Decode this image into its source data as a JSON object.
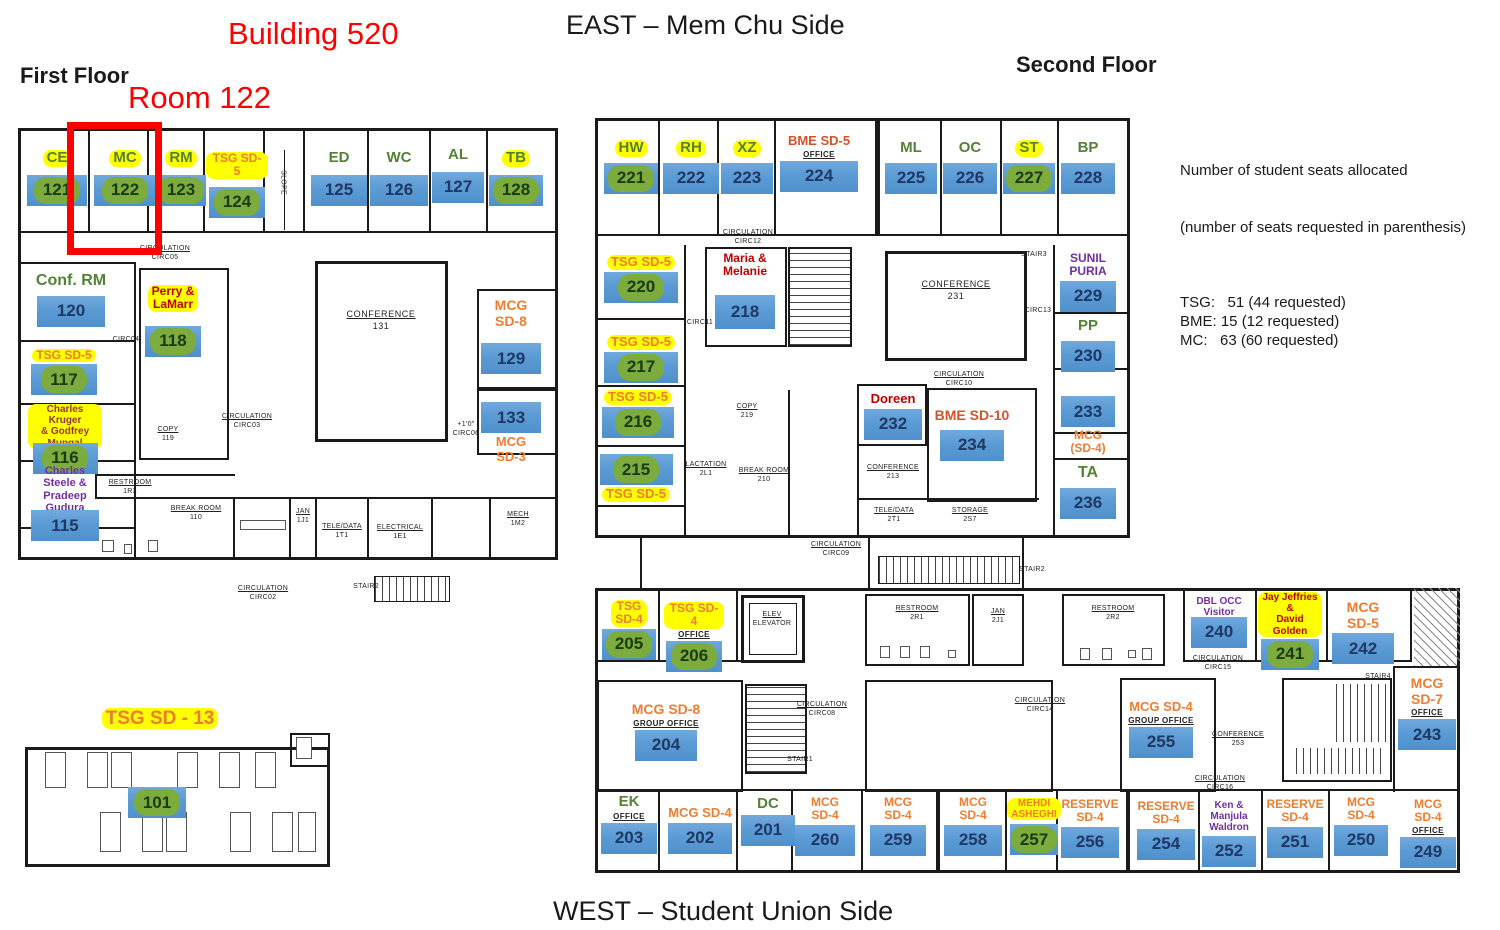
{
  "titles": {
    "building": "Building 520",
    "room_callout": "Room 122",
    "east_side": "EAST – Mem Chu Side",
    "west_side": "WEST – Student Union Side",
    "first_floor": "First Floor",
    "second_floor": "Second Floor"
  },
  "legend": {
    "heading1": "Number of student seats allocated",
    "heading2": "(number of seats requested in parenthesis)",
    "entries": [
      "TSG:   51 (44 requested)",
      "BME: 15 (12 requested)",
      "MC:   63 (60 requested)"
    ]
  },
  "colors": {
    "bar_blue": "#5b9bd5",
    "bar_text": "#1f3864",
    "pill_green": "#7cab3e",
    "pill_text": "#1c3a11",
    "highlight_yellow": "#ffff00",
    "label_green": "#538135",
    "label_orange": "#ed7d31",
    "label_red": "#c00000",
    "label_red_orange": "#d9512c",
    "label_purple": "#7030a0",
    "label_dark_red": "#943634",
    "title_red": "#ff0000",
    "plan_line": "#1a1a1a"
  },
  "floors": [
    {
      "name": "First Floor",
      "rooms": [
        {
          "l": "CE",
          "ls": "gy",
          "n": "121",
          "ns": "pill",
          "x": 26,
          "y": 150,
          "w": 62,
          "bw": 60,
          "fs": 15,
          "mt": 8
        },
        {
          "l": "MC",
          "ls": "gy",
          "n": "122",
          "ns": "pill",
          "x": 93,
          "y": 150,
          "w": 64,
          "bw": 62,
          "fs": 15,
          "mt": 8
        },
        {
          "l": "RM",
          "ls": "gy",
          "n": "123",
          "ns": "pill",
          "x": 156,
          "y": 150,
          "w": 50,
          "bw": 50,
          "fs": 15,
          "mt": 8
        },
        {
          "l": "TSG SD-5",
          "ls": "oy",
          "n": "124",
          "ns": "pill",
          "x": 206,
          "y": 152,
          "w": 62,
          "bw": 56,
          "fs": 12,
          "mt": 8
        },
        {
          "l": "ED",
          "ls": "g",
          "n": "125",
          "ns": "bar",
          "x": 310,
          "y": 150,
          "w": 58,
          "bw": 56,
          "fs": 15,
          "mt": 8
        },
        {
          "l": "WC",
          "ls": "g",
          "n": "126",
          "ns": "bar",
          "x": 370,
          "y": 150,
          "w": 58,
          "bw": 58,
          "fs": 15,
          "mt": 8
        },
        {
          "l": "AL",
          "ls": "g",
          "n": "127",
          "ns": "bar",
          "x": 430,
          "y": 147,
          "w": 56,
          "bw": 52,
          "fs": 15,
          "mt": 8
        },
        {
          "l": "TB",
          "ls": "gy",
          "n": "128",
          "ns": "pill",
          "x": 488,
          "y": 150,
          "w": 56,
          "bw": 54,
          "fs": 15,
          "mt": 8
        },
        {
          "l": "Conf. RM",
          "ls": "g",
          "n": "120",
          "ns": "bar",
          "x": 28,
          "y": 272,
          "w": 86,
          "bw": 68,
          "fs": 16,
          "mt": 6
        },
        {
          "l": "TSG SD-5",
          "ls": "oy",
          "n": "117",
          "ns": "pill",
          "x": 28,
          "y": 349,
          "w": 72,
          "bw": 66,
          "fs": 12
        },
        {
          "l": "Charles Kruger\n& Godfrey\nMungal",
          "ls": "dy",
          "n": "116",
          "ns": "pill",
          "x": 28,
          "y": 404,
          "w": 74,
          "bw": 65,
          "fs": 10,
          "mt": -6
        },
        {
          "l": "Charles Steele &\nPradeep Gudura",
          "ls": "p",
          "n": "115",
          "ns": "bar",
          "x": 26,
          "y": 465,
          "w": 78,
          "bw": 68,
          "fs": 11,
          "mt": -4
        },
        {
          "l": "Perry &\nLaMarr",
          "ls": "ry",
          "n": "118",
          "ns": "pill",
          "x": 142,
          "y": 285,
          "w": 62,
          "bw": 56,
          "fs": 12,
          "mt": 14
        },
        {
          "l": "MCG\nSD-8",
          "ls": "o",
          "n": "129",
          "ns": "bar",
          "x": 480,
          "y": 298,
          "w": 62,
          "bw": 60,
          "fs": 14,
          "mt": 14
        },
        {
          "n": "133",
          "ns": "bar",
          "x": 480,
          "y": 400,
          "w": 62,
          "bw": 60,
          "lb": "MCG SD-3",
          "lbs": "o",
          "lbfs": 13
        },
        {
          "l": "TSG SD - 13",
          "ls": "oy",
          "x": 92,
          "y": 708,
          "w": 136,
          "fs": 19
        },
        {
          "n": "101",
          "ns": "pill",
          "x": 126,
          "y": 785,
          "w": 62,
          "bw": 58
        }
      ],
      "plan_labels": [
        {
          "t": "CIRCULATION",
          "s": "CIRC05",
          "x": 165,
          "y": 244
        },
        {
          "t": "CIRC04",
          "x": 126,
          "y": 335,
          "plain": 1
        },
        {
          "t": "CONFERENCE",
          "s": "131",
          "x": 381,
          "y": 309,
          "big": 1
        },
        {
          "t": "CIRCULATION",
          "s": "CIRC03",
          "x": 247,
          "y": 412
        },
        {
          "t": "COPY",
          "s": "119",
          "x": 168,
          "y": 425
        },
        {
          "t": "+1'0\"",
          "s": "CIRC06",
          "x": 466,
          "y": 420,
          "plain": 1
        },
        {
          "t": "RESTROOM",
          "s": "1R3",
          "x": 130,
          "y": 478
        },
        {
          "t": "BREAK ROOM",
          "s": "110",
          "x": 196,
          "y": 504
        },
        {
          "t": "JAN",
          "s": "1J1",
          "x": 303,
          "y": 507
        },
        {
          "t": "TELE/DATA",
          "s": "1T1",
          "x": 342,
          "y": 522
        },
        {
          "t": "ELECTRICAL",
          "s": "1E1",
          "x": 400,
          "y": 523
        },
        {
          "t": "MECH",
          "s": "1M2",
          "x": 518,
          "y": 510
        },
        {
          "t": "CIRCULATION",
          "s": "CIRC02",
          "x": 263,
          "y": 584
        },
        {
          "t": "STAIR2",
          "x": 366,
          "y": 582,
          "plain": 1
        },
        {
          "t": "SLOPE",
          "x": 283,
          "y": 178,
          "rot": 1,
          "plain": 1
        }
      ]
    },
    {
      "name": "Second Floor",
      "rooms": [
        {
          "l": "HW",
          "ls": "gy",
          "n": "221",
          "ns": "pill",
          "x": 602,
          "y": 140,
          "w": 58,
          "bw": 54,
          "fs": 15,
          "mt": 6
        },
        {
          "l": "RH",
          "ls": "gy",
          "n": "222",
          "ns": "bar",
          "x": 662,
          "y": 140,
          "w": 58,
          "bw": 56,
          "fs": 15,
          "mt": 6
        },
        {
          "l": "XZ",
          "ls": "gy",
          "n": "223",
          "ns": "bar",
          "x": 720,
          "y": 140,
          "w": 54,
          "bw": 52,
          "fs": 15,
          "mt": 6
        },
        {
          "l": "BME SD-5",
          "ls": "ro",
          "n": "224",
          "ns": "bar",
          "x": 776,
          "y": 134,
          "w": 86,
          "bw": 78,
          "fs": 13,
          "sub": "OFFICE"
        },
        {
          "l": "ML",
          "ls": "g",
          "n": "225",
          "ns": "bar",
          "x": 884,
          "y": 140,
          "w": 54,
          "bw": 52,
          "fs": 15,
          "mt": 6
        },
        {
          "l": "OC",
          "ls": "g",
          "n": "226",
          "ns": "bar",
          "x": 942,
          "y": 140,
          "w": 56,
          "bw": 54,
          "fs": 15,
          "mt": 6
        },
        {
          "l": "ST",
          "ls": "gy",
          "n": "227",
          "ns": "pill",
          "x": 1002,
          "y": 140,
          "w": 54,
          "bw": 52,
          "fs": 15,
          "mt": 6
        },
        {
          "l": "BP",
          "ls": "g",
          "n": "228",
          "ns": "bar",
          "x": 1060,
          "y": 140,
          "w": 56,
          "bw": 54,
          "fs": 15,
          "mt": 6
        },
        {
          "l": "TSG SD-5",
          "ls": "oy",
          "n": "220",
          "ns": "pill",
          "x": 602,
          "y": 255,
          "w": 78,
          "bw": 74,
          "fs": 13
        },
        {
          "l": "Maria &\nMelanie",
          "ls": "r",
          "n": "218",
          "ns": "bar",
          "x": 712,
          "y": 252,
          "w": 66,
          "bw": 60,
          "bh": 34,
          "fs": 12,
          "mt": 16
        },
        {
          "l": "TSG SD-5",
          "ls": "oy",
          "n": "217",
          "ns": "pill",
          "x": 602,
          "y": 335,
          "w": 78,
          "bw": 74,
          "fs": 13
        },
        {
          "l": "TSG SD-5",
          "ls": "oy",
          "n": "216",
          "ns": "pill",
          "x": 600,
          "y": 390,
          "w": 76,
          "bw": 72,
          "fs": 13
        },
        {
          "n": "215",
          "ns": "pill",
          "x": 598,
          "y": 452,
          "w": 76,
          "bw": 73,
          "lb": "TSG SD-5",
          "lbs": "oy",
          "lbfs": 13
        },
        {
          "l": "Doreen",
          "ls": "r",
          "n": "232",
          "ns": "bar",
          "x": 862,
          "y": 392,
          "w": 62,
          "bw": 58,
          "fs": 13
        },
        {
          "l": "BME SD-10",
          "ls": "ro",
          "n": "234",
          "ns": "bar",
          "x": 928,
          "y": 408,
          "w": 88,
          "bw": 64,
          "fs": 14,
          "mt": 6
        },
        {
          "l": "SUNIL\nPURIA",
          "ls": "p",
          "n": "229",
          "ns": "bar",
          "x": 1056,
          "y": 252,
          "w": 64,
          "bw": 56,
          "fs": 12
        },
        {
          "l": "PP",
          "ls": "g",
          "n": "230",
          "ns": "bar",
          "x": 1058,
          "y": 318,
          "w": 60,
          "bw": 54,
          "fs": 15,
          "mt": 6
        },
        {
          "n": "233",
          "ns": "bar",
          "x": 1058,
          "y": 394,
          "w": 60,
          "bw": 54,
          "lb": "MCG\n(SD-4)",
          "lbs": "o",
          "lbfs": 12
        },
        {
          "l": "TA",
          "ls": "g",
          "n": "236",
          "ns": "bar",
          "x": 1058,
          "y": 464,
          "w": 60,
          "bw": 56,
          "fs": 16,
          "mt": 6
        },
        {
          "l": "TSG\nSD-4",
          "ls": "oy",
          "n": "205",
          "ns": "pill",
          "x": 600,
          "y": 600,
          "w": 58,
          "bw": 54,
          "fs": 12
        },
        {
          "l": "TSG SD-4",
          "ls": "oy",
          "n": "206",
          "ns": "pill",
          "x": 664,
          "y": 602,
          "w": 60,
          "bw": 56,
          "fs": 12,
          "sub": "OFFICE"
        },
        {
          "l": "DBL OCC\nVisitor\nEmeriti",
          "ls": "p",
          "n": "240",
          "ns": "bar",
          "x": 1186,
          "y": 596,
          "w": 66,
          "bw": 56,
          "fs": 10,
          "mt": -13
        },
        {
          "l": "Jay Jeffries &\nDavid Golden",
          "ls": "ry",
          "n": "241",
          "ns": "pill",
          "x": 1258,
          "y": 592,
          "w": 64,
          "bw": 58,
          "fs": 10
        },
        {
          "l": "MCG SD-5",
          "ls": "o",
          "n": "242",
          "ns": "bar",
          "x": 1330,
          "y": 600,
          "w": 66,
          "bw": 62,
          "fs": 14
        },
        {
          "l": "MCG SD-8",
          "ls": "o",
          "n": "204",
          "ns": "bar",
          "x": 620,
          "y": 702,
          "w": 92,
          "bw": 62,
          "fs": 14,
          "sub": "GROUP OFFICE"
        },
        {
          "l": "MCG SD-4",
          "ls": "o",
          "n": "255",
          "ns": "bar",
          "x": 1124,
          "y": 700,
          "w": 74,
          "bw": 64,
          "fs": 13,
          "sub": "GROUP OFFICE"
        },
        {
          "l": "MCG\nSD-7",
          "ls": "o",
          "n": "243",
          "ns": "bar",
          "x": 1396,
          "y": 676,
          "w": 62,
          "bw": 58,
          "fs": 14,
          "sub": "OFFICE"
        },
        {
          "l": "EK",
          "ls": "g",
          "n": "203",
          "ns": "bar",
          "x": 600,
          "y": 794,
          "w": 58,
          "bw": 56,
          "fs": 15,
          "sub": "OFFICE"
        },
        {
          "l": "MCG SD-4",
          "ls": "o",
          "n": "202",
          "ns": "bar",
          "x": 664,
          "y": 806,
          "w": 72,
          "bw": 64,
          "fs": 13
        },
        {
          "l": "DC",
          "ls": "g",
          "n": "201",
          "ns": "bar",
          "x": 740,
          "y": 796,
          "w": 56,
          "bw": 54,
          "fs": 15
        },
        {
          "l": "MCG\nSD-4",
          "ls": "o",
          "n": "260",
          "ns": "bar",
          "x": 794,
          "y": 796,
          "w": 62,
          "bw": 60,
          "fs": 12
        },
        {
          "l": "MCG\nSD-4",
          "ls": "o",
          "n": "259",
          "ns": "bar",
          "x": 868,
          "y": 796,
          "w": 60,
          "bw": 56,
          "fs": 12
        },
        {
          "l": "MCG\nSD-4",
          "ls": "o",
          "n": "258",
          "ns": "bar",
          "x": 942,
          "y": 796,
          "w": 62,
          "bw": 58,
          "fs": 12
        },
        {
          "l": "MEHDI\nASHEGHI",
          "ls": "oy",
          "n": "257",
          "ns": "pill",
          "x": 1008,
          "y": 798,
          "w": 52,
          "bw": 48,
          "fs": 10,
          "mt": 4
        },
        {
          "l": "RESERVE\nSD-4",
          "ls": "o",
          "n": "256",
          "ns": "bar",
          "x": 1060,
          "y": 798,
          "w": 60,
          "bw": 58,
          "fs": 12
        },
        {
          "l": "RESERVE\nSD-4",
          "ls": "o",
          "n": "254",
          "ns": "bar",
          "x": 1136,
          "y": 800,
          "w": 60,
          "bw": 58,
          "fs": 12
        },
        {
          "l": "Ken & Manjula\nWaldron",
          "ls": "p",
          "n": "252",
          "ns": "bar",
          "x": 1200,
          "y": 800,
          "w": 58,
          "bw": 54,
          "fs": 10
        },
        {
          "l": "RESERVE\nSD-4",
          "ls": "o",
          "n": "251",
          "ns": "bar",
          "x": 1264,
          "y": 798,
          "w": 62,
          "bw": 56,
          "fs": 12
        },
        {
          "l": "MCG\nSD-4",
          "ls": "o",
          "n": "250",
          "ns": "bar",
          "x": 1332,
          "y": 796,
          "w": 58,
          "bw": 54,
          "fs": 12
        },
        {
          "l": "MCG\nSD-4",
          "ls": "o",
          "n": "249",
          "ns": "bar",
          "x": 1398,
          "y": 798,
          "w": 60,
          "bw": 56,
          "fs": 12,
          "sub": "OFFICE"
        }
      ],
      "plan_labels": [
        {
          "t": "CIRCULATION",
          "s": "CIRC12",
          "x": 748,
          "y": 228
        },
        {
          "t": "CIRC11",
          "x": 700,
          "y": 318,
          "plain": 1
        },
        {
          "t": "CONFERENCE",
          "s": "231",
          "x": 956,
          "y": 279,
          "big": 1
        },
        {
          "t": "CIRC13",
          "x": 1038,
          "y": 306,
          "plain": 1
        },
        {
          "t": "STAIR3",
          "x": 1034,
          "y": 250,
          "plain": 1
        },
        {
          "t": "CIRCULATION",
          "s": "CIRC10",
          "x": 959,
          "y": 370
        },
        {
          "t": "COPY",
          "s": "219",
          "x": 747,
          "y": 402
        },
        {
          "t": "LACTATION",
          "s": "2L1",
          "x": 706,
          "y": 460
        },
        {
          "t": "BREAK ROOM",
          "s": "210",
          "x": 764,
          "y": 466
        },
        {
          "t": "CONFERENCE",
          "s": "213",
          "x": 893,
          "y": 463
        },
        {
          "t": "TELE/DATA",
          "s": "2T1",
          "x": 894,
          "y": 506
        },
        {
          "t": "STORAGE",
          "s": "2S7",
          "x": 970,
          "y": 506
        },
        {
          "t": "CIRCULATION",
          "s": "CIRC09",
          "x": 836,
          "y": 540
        },
        {
          "t": "STAIR2",
          "x": 1032,
          "y": 565,
          "plain": 1
        },
        {
          "t": "RESTROOM",
          "s": "2R1",
          "x": 917,
          "y": 604
        },
        {
          "t": "JAN",
          "s": "2J1",
          "x": 998,
          "y": 607
        },
        {
          "t": "RESTROOM",
          "s": "2R2",
          "x": 1113,
          "y": 604
        },
        {
          "t": "ELEV",
          "s": "ELEVATOR",
          "x": 772,
          "y": 610
        },
        {
          "t": "CIRCULATION",
          "s": "CIRC15",
          "x": 1218,
          "y": 654
        },
        {
          "t": "STAIR4",
          "x": 1378,
          "y": 672,
          "plain": 1
        },
        {
          "t": "CIRCULATION",
          "s": "CIRC08",
          "x": 822,
          "y": 700
        },
        {
          "t": "STAIR1",
          "x": 800,
          "y": 755,
          "plain": 1
        },
        {
          "t": "CIRCULATION",
          "s": "CIRC14",
          "x": 1040,
          "y": 696
        },
        {
          "t": "CONFERENCE",
          "s": "253",
          "x": 1238,
          "y": 730
        },
        {
          "t": "CIRCULATION",
          "s": "CIRC16",
          "x": 1220,
          "y": 774
        }
      ]
    }
  ]
}
